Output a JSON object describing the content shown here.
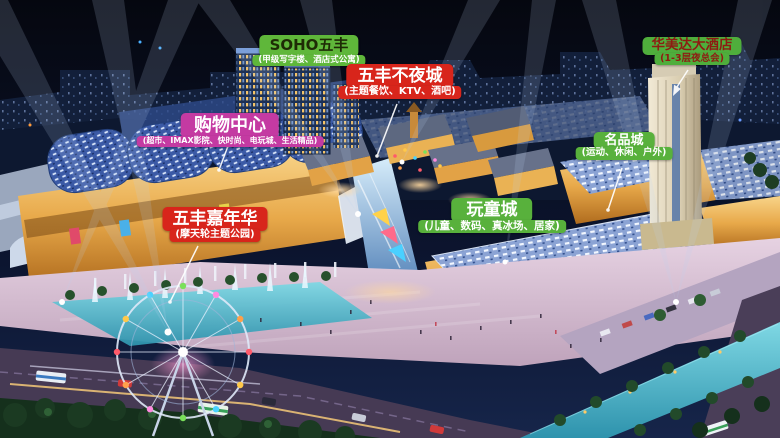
{
  "labels": {
    "soho": {
      "title": "SOHO五丰",
      "subtitle": "(甲级写字楼、酒店式公寓)",
      "bg": "#5fb73a",
      "title_color": "#1e2b05",
      "subtitle_color": "#ffffff"
    },
    "night_city": {
      "title": "五丰不夜城",
      "subtitle": "(主题餐饮、KTV、酒吧)",
      "bg": "#d8251b",
      "title_color": "#ffffff",
      "subtitle_color": "#ffffff"
    },
    "shopping_mall": {
      "title": "购物中心",
      "subtitle": "(超市、IMAX影院、快时尚、电玩城、生活精品)",
      "bg": "#c43aa2",
      "title_color": "#ffffff",
      "subtitle_color": "#ffffff"
    },
    "carnival": {
      "title": "五丰嘉年华",
      "subtitle": "(摩天轮主题公园)",
      "bg": "#d8251b",
      "title_color": "#ffffff",
      "subtitle_color": "#ffffff"
    },
    "kids_city": {
      "title": "玩童城",
      "subtitle": "(儿童、数码、真冰场、居家)",
      "bg": "#58b13c",
      "title_color": "#ffffff",
      "subtitle_color": "#ffffff"
    },
    "brand_city": {
      "title": "名品城",
      "subtitle": "(运动、休闲、户外)",
      "bg": "#58b13c",
      "title_color": "#ffffff",
      "subtitle_color": "#ffffff"
    },
    "hotel": {
      "title": "华美达大酒店",
      "subtitle": "(1-3层夜总会)",
      "bg": "#4fae3c",
      "title_color": "#8e1b12",
      "subtitle_color": "#8e1b12"
    }
  },
  "palette": {
    "sky_top": "#05070f",
    "sky_bottom": "#16254a",
    "skyline": "#121f3a",
    "facade_gold": "#e8a94a",
    "roof_blue": "#3b5aa6",
    "roof_speckle": "#8ba3d4",
    "water": "#45b4c6",
    "plaza": "#d7bcd0",
    "road": "#463a54",
    "trees": "#1d3d24",
    "beam": "#bdd3f2",
    "hotel_tower": "#e9e0c8",
    "leader_line": "#ffffff"
  }
}
